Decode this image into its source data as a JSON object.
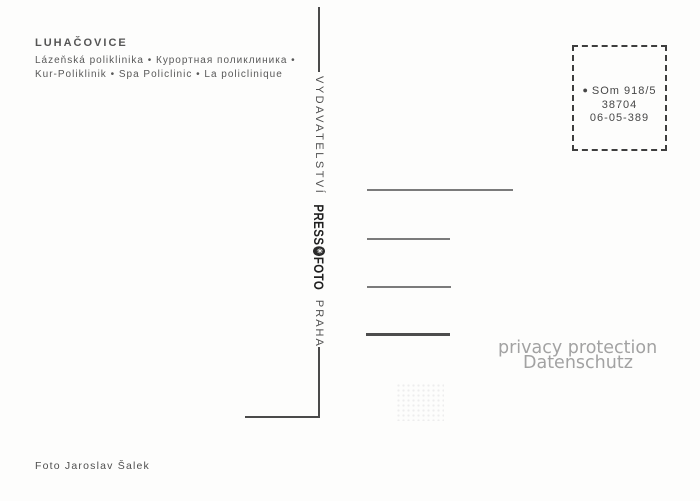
{
  "caption": {
    "title": "LUHAČOVICE",
    "line1": "Lázeňská poliklinika • Курортная поликлиника •",
    "line2": "Kur-Poliklinik • Spa Policlinic • La policlinique",
    "photo_credit": "Foto Jaroslav Šalek"
  },
  "spine": {
    "publisher": "VYDAVATELSTVÍ",
    "logo_press": "PRESS",
    "logo_foto": "FOTO",
    "city": "PRAHA"
  },
  "icons": {
    "ctk_emblem_glyph": "✳",
    "stamp_bullet_glyph": "●"
  },
  "stamp_box": {
    "code": "SOm 918/5",
    "number": "38704",
    "date_code": "06-05-389"
  },
  "watermark": {
    "line1": "privacy protection",
    "line2": "Datenschutz"
  },
  "colors": {
    "background": "#fdfdfc",
    "ink": "#4a4a4a",
    "logo_ink": "#1f1f1f",
    "watermark_gray": "#a2a2a2"
  }
}
